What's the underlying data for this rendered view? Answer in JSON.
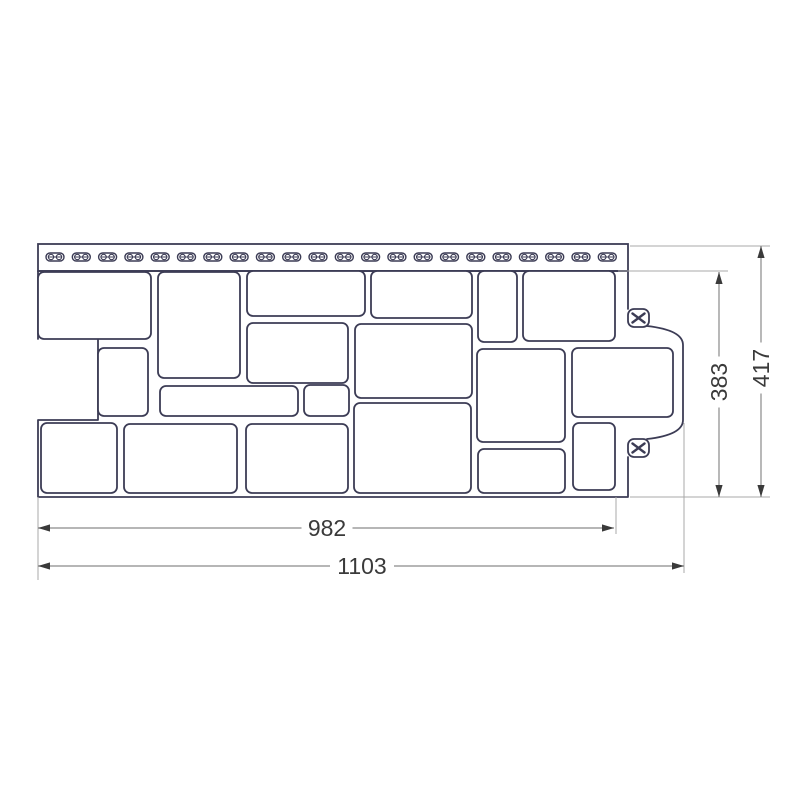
{
  "page": {
    "background": "#ffffff",
    "description_name": "facade-panel-technical-drawing"
  },
  "colors": {
    "panel_line": "#3c3c55",
    "panel_fill": "#ffffff",
    "dim_line": "#8a8a8a",
    "ext_line": "#a8a8a8",
    "dim_arrow": "#3a3a3a",
    "dim_text": "#3a3a3a"
  },
  "dimensions": {
    "useful_width": {
      "label": "982"
    },
    "total_width": {
      "label": "1103"
    },
    "useful_height": {
      "label": "383"
    },
    "total_height": {
      "label": "417"
    }
  },
  "icons": {
    "nail_slot": "oblong-nail-hole-icon",
    "fastener_slot": "x-fastener-slot-icon"
  },
  "drawing": {
    "strip": {
      "x": 38,
      "y": 244,
      "w": 590,
      "h": 27,
      "slot_count": 22,
      "slot_start": 55,
      "slot_pitch": 26.3,
      "slot_cy": 257,
      "slot_w": 18,
      "slot_h": 8
    },
    "outline_path": "M 38 271 H 628 V 309 M 38 271 V 339 M 98 339 V 420 H 38 V 497 H 628 V 457 M 647 326 C 665 328 683 333 683 345 L 683 420 C 683 432 665 437 647 439",
    "blocks": [
      [
        38,
        272,
        113,
        67
      ],
      [
        158,
        272,
        82,
        106
      ],
      [
        247,
        271,
        118,
        45
      ],
      [
        371,
        271,
        101,
        47
      ],
      [
        478,
        271,
        39,
        71
      ],
      [
        523,
        271,
        92,
        70
      ],
      [
        247,
        323,
        101,
        60
      ],
      [
        355,
        324,
        117,
        74
      ],
      [
        98,
        348,
        50,
        68
      ],
      [
        477,
        349,
        88,
        93
      ],
      [
        572,
        348,
        101,
        69
      ],
      [
        160,
        386,
        138,
        30
      ],
      [
        304,
        385,
        45,
        31
      ],
      [
        41,
        423,
        76,
        70
      ],
      [
        124,
        424,
        113,
        69
      ],
      [
        246,
        424,
        102,
        69
      ],
      [
        354,
        403,
        117,
        90
      ],
      [
        478,
        449,
        87,
        44
      ],
      [
        573,
        423,
        42,
        67
      ]
    ],
    "fastener_slots": [
      [
        628,
        309
      ],
      [
        628,
        439
      ]
    ],
    "fastener_slot_size": {
      "w": 21,
      "h": 18
    },
    "ext_lines": [
      [
        38,
        497,
        38,
        580
      ],
      [
        616,
        497,
        616,
        534
      ],
      [
        684,
        423,
        684,
        573
      ],
      [
        630,
        497,
        770,
        497
      ],
      [
        630,
        246,
        770,
        246
      ],
      [
        618,
        271,
        728,
        271
      ]
    ],
    "dims": [
      {
        "orient": "h",
        "y": 528,
        "x1": 38,
        "x2": 614,
        "key": "useful_width",
        "tc": 327
      },
      {
        "orient": "h",
        "y": 566,
        "x1": 38,
        "x2": 684,
        "key": "total_width",
        "tc": 362
      },
      {
        "orient": "v",
        "x": 719,
        "y1": 272,
        "y2": 497,
        "key": "useful_height",
        "tc": 382
      },
      {
        "orient": "v",
        "x": 761,
        "y1": 246,
        "y2": 497,
        "key": "total_height",
        "tc": 368
      }
    ]
  }
}
